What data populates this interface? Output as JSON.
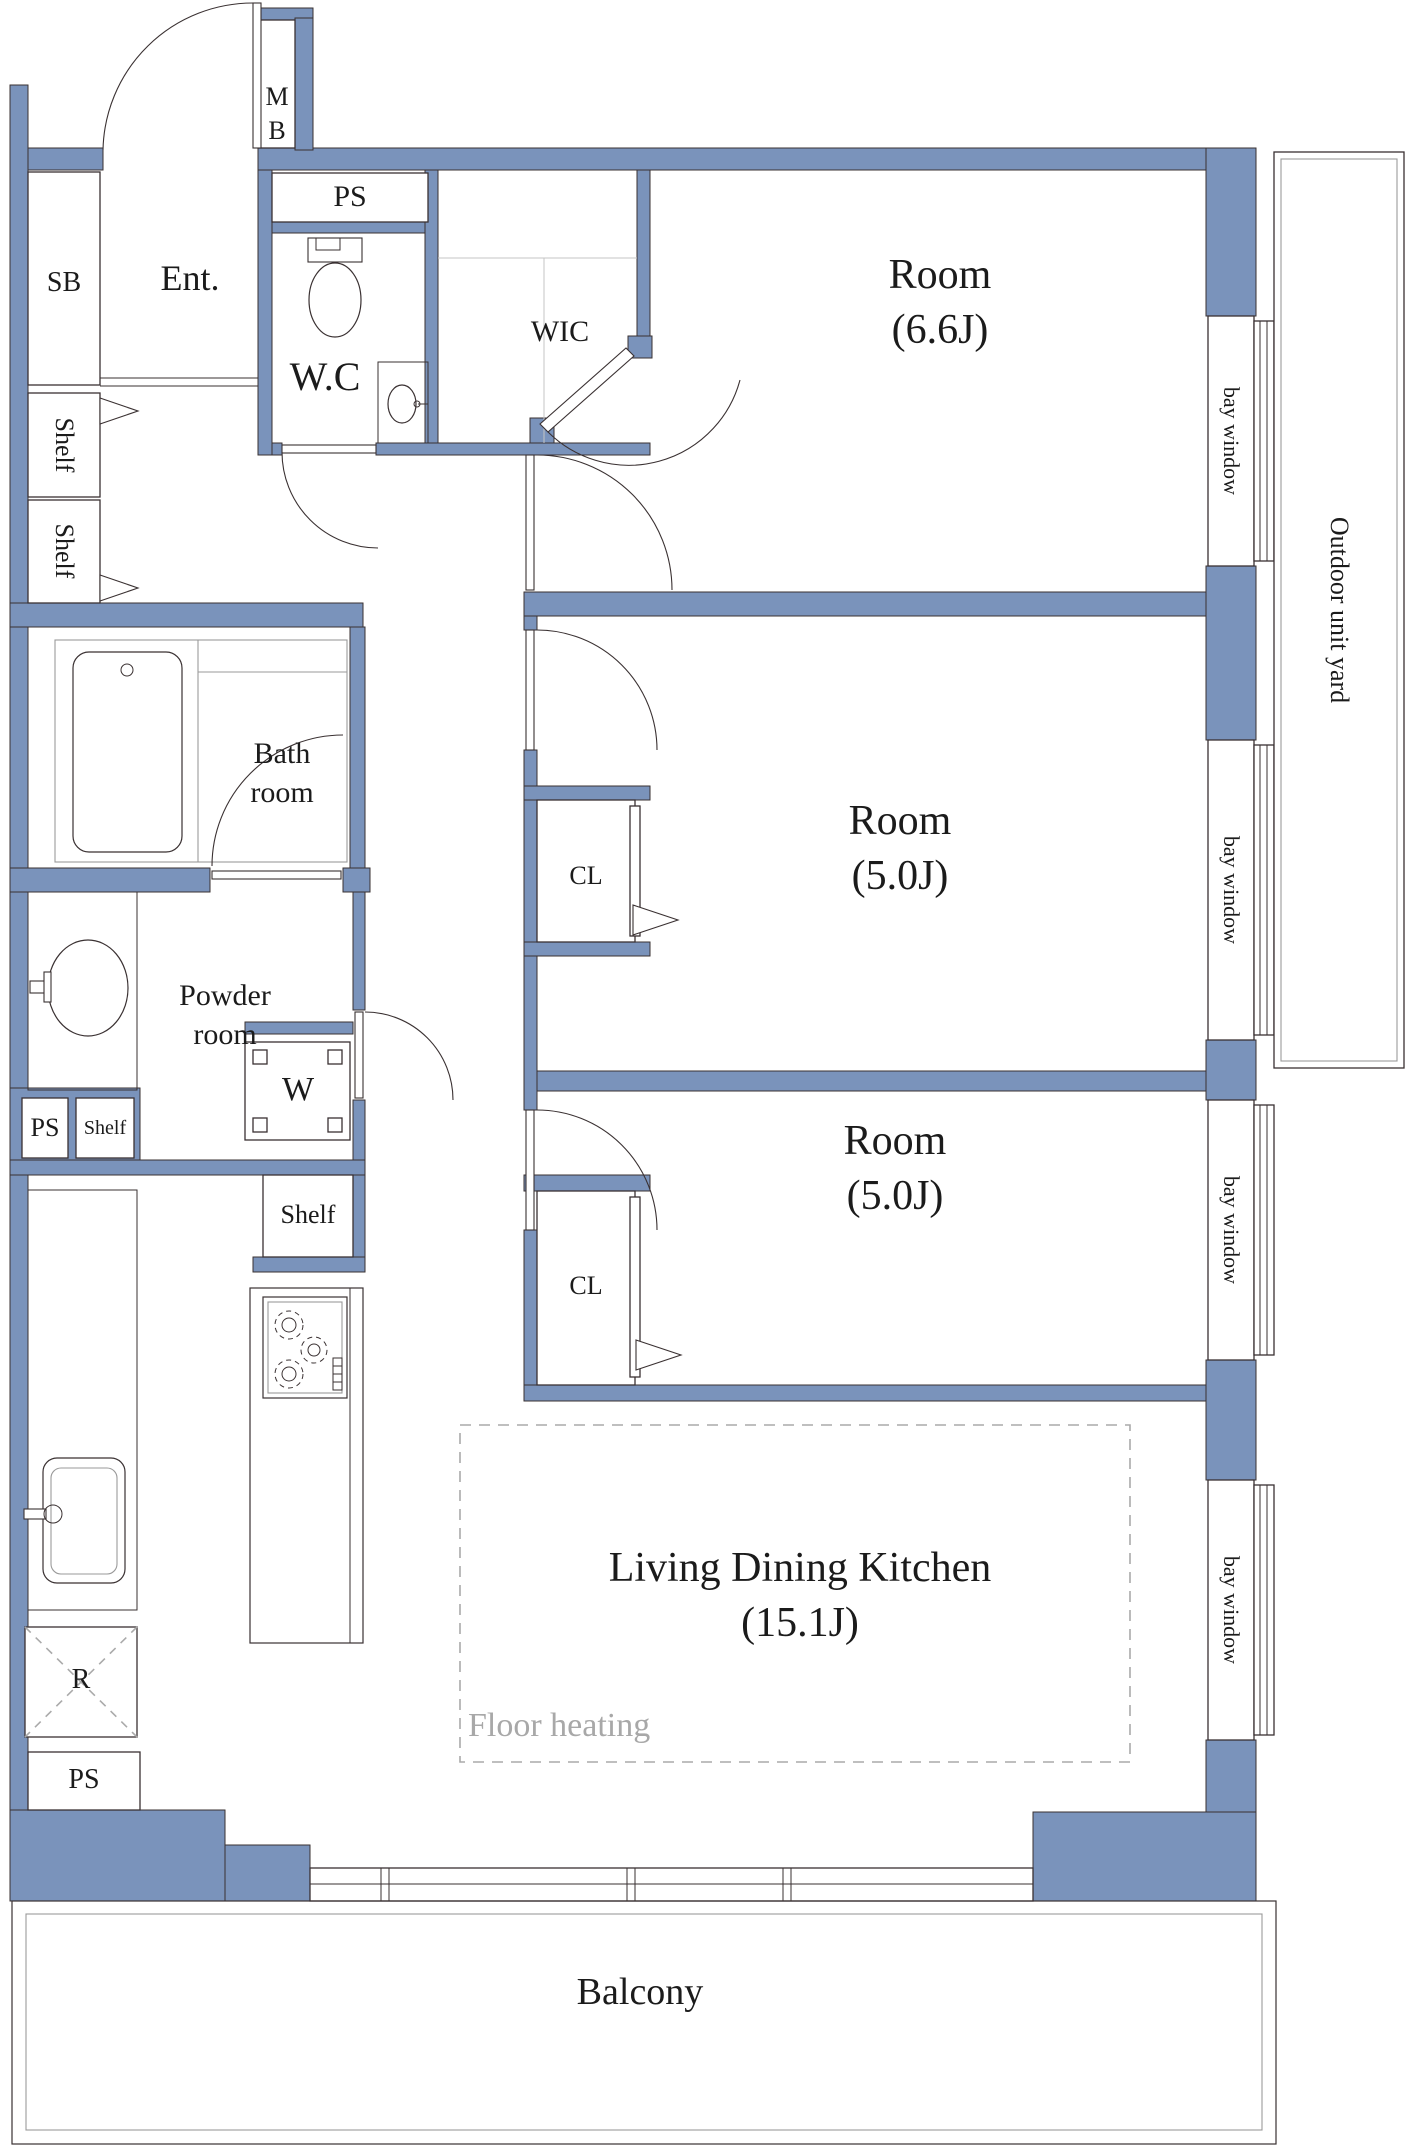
{
  "colors": {
    "wall": "#7a93bb",
    "line": "#3a3132",
    "fixture_line": "#9a9a9a",
    "floor_heating_dash": "#aaaaaa",
    "text": "#1b1b1b"
  },
  "labels": {
    "meter_box": "MB",
    "entrance": "Ent.",
    "shoe_box": "SB",
    "pipe_space_wc": "PS",
    "water_closet": "W.C",
    "walk_in_closet": "WIC",
    "shelf_hall_upper": "Shelf",
    "shelf_hall_lower": "Shelf",
    "bathroom": "Bath room",
    "powder_room": "Powder room",
    "washing_machine": "W",
    "pipe_space_kitchen": "PS",
    "shelf_kitchen_small": "Shelf",
    "shelf_kitchen": "Shelf",
    "closet_middle": "CL",
    "closet_lower": "CL",
    "refrigerator": "R",
    "pipe_space_bottom": "PS",
    "floor_heating": "Floor heating",
    "balcony": "Balcony",
    "bay_window": "bay window",
    "outdoor_unit_yard": "Outdoor unit yard"
  },
  "rooms": [
    {
      "name": "Room",
      "size": "(6.6J)"
    },
    {
      "name": "Room",
      "size": "(5.0J)"
    },
    {
      "name": "Room",
      "size": "(5.0J)"
    },
    {
      "name": "Living Dining Kitchen",
      "size": "(15.1J)"
    }
  ]
}
